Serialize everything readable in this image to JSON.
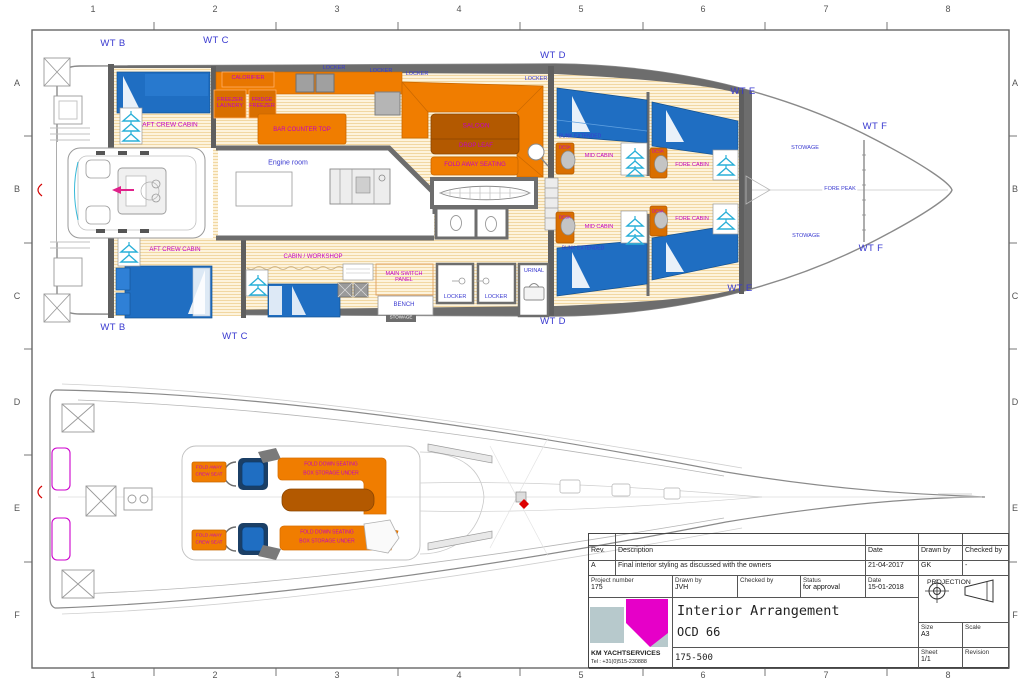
{
  "frame": {
    "cols": [
      "1",
      "2",
      "3",
      "4",
      "5",
      "6",
      "7",
      "8"
    ],
    "rows": [
      "A",
      "B",
      "C",
      "D",
      "E",
      "F"
    ]
  },
  "plan": {
    "wt": {
      "b_top": "WT B",
      "c_top": "WT C",
      "d_top": "WT D",
      "e_top": "WT E",
      "f_top": "WT F",
      "f_bot": "WT F",
      "e_bot": "WT E",
      "d_bot": "WT D",
      "c_bot": "WT C",
      "b_bot": "WT B"
    },
    "labels": {
      "aft_crew_cabin": "AFT CREW CABIN",
      "cabin_workshop": "CABIN / WORKSHOP",
      "engine_room": "Engine room",
      "calorifier": "CALORIFIER",
      "freezer_laundry": "FREEZER LAUNDRY",
      "fridge_freezer": "FRIDGE FREEZER",
      "bar_counter_top": "BAR COUNTER TOP",
      "saloon": "SALOON",
      "drop_leaf": "DROP LEAF",
      "fold_away_seating": "FOLD AWAY SEATING",
      "locker": "LOCKER",
      "urinal": "URINAL",
      "bench": "BENCH",
      "main_switch_panel": "MAIN SWITCH PANEL",
      "stowage_strip": "STOWAGE",
      "mid_cabin": "MID CABIN",
      "fore_cabin": "FORE CABIN",
      "bunk_extended": "BUNK EXTENDED",
      "desk": "DESK",
      "stowage": "STOWAGE",
      "fore_peak": "FORE PEAK"
    }
  },
  "deck": {
    "labels": {
      "fold_away_1": "FOLD AWAY",
      "fold_away_2": "CREW SEAT",
      "bench_1": "FOLD DOWN SEATING",
      "bench_2": "BOX STORAGE UNDER"
    }
  },
  "title_block": {
    "rev_header": {
      "rev": "Rev.",
      "description": "Description",
      "date": "Date",
      "drawn_by": "Drawn by",
      "checked_by": "Checked by"
    },
    "rev_row": {
      "rev": "A",
      "description": "Final interior styling as discussed with the owners",
      "date": "21-04-2017",
      "drawn_by": "GK",
      "checked_by": "-"
    },
    "project": {
      "label": "Project number",
      "value": "175"
    },
    "drawn": {
      "label": "Drawn by",
      "value": "JVH"
    },
    "checked": {
      "label": "Checked by",
      "value": ""
    },
    "status": {
      "label": "Status",
      "value": "for approval"
    },
    "date": {
      "label": "Date",
      "value": "15-01-2018"
    },
    "projection_label": "PROJECTION",
    "title_line1": "Interior Arrangement",
    "title_line2": "OCD 66",
    "doc_number": "175-500",
    "size": {
      "label": "Size",
      "value": "A3"
    },
    "scale": {
      "label": "Scale",
      "value": ""
    },
    "sheet": {
      "label": "Sheet",
      "value": "1/1"
    },
    "revision": {
      "label": "Revision",
      "value": ""
    },
    "company": {
      "name": "KM YACHTSERVICES",
      "tel": "Tel : +31(0)515-230888"
    }
  },
  "colors": {
    "accent_orange": "#f07d00",
    "table_brown": "#b35900",
    "bed_blue": "#1f6ec2",
    "deck_gray": "#6d6d6d",
    "label_magenta": "#c400c4",
    "label_blue": "#3a3ad0",
    "logo_magenta": "#e600c8"
  }
}
